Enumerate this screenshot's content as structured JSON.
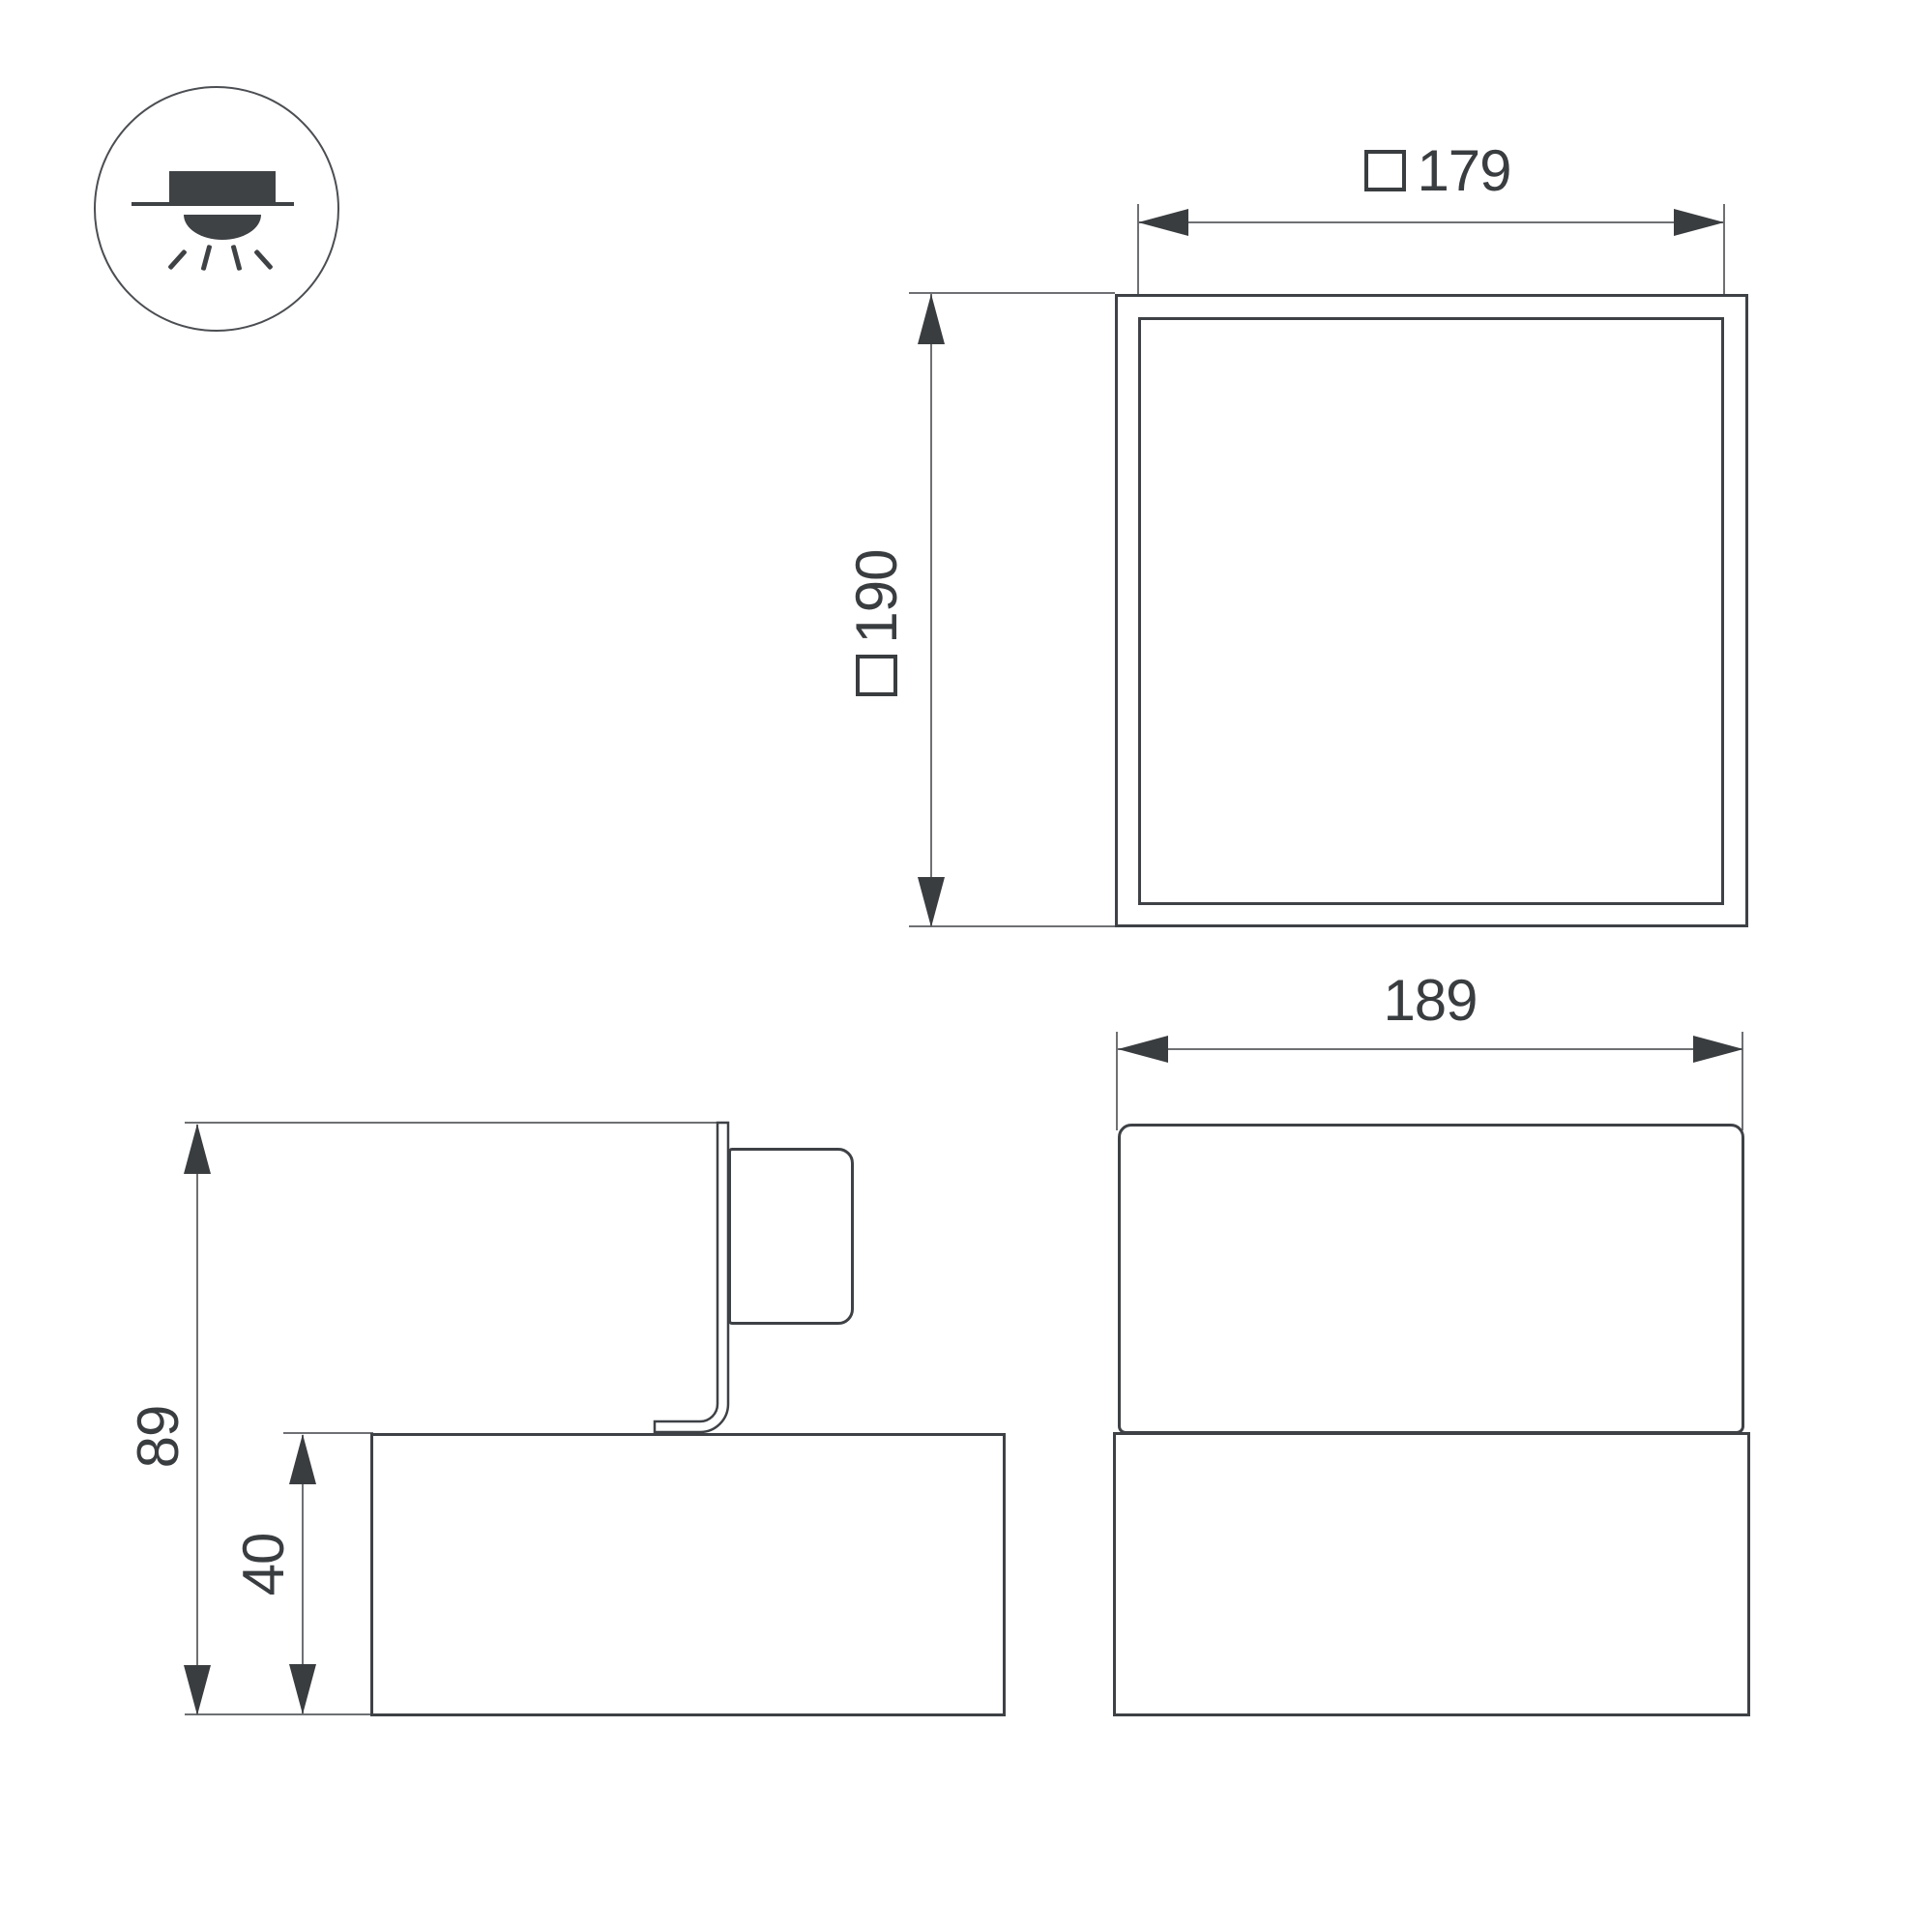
{
  "colors": {
    "background": "#ffffff",
    "outline": "#3e4145",
    "dimension_lines": "#6e7073",
    "text": "#3a3d40"
  },
  "icon": {
    "name": "surface-mounted-downlight",
    "glyphs": [
      "lamp-body",
      "ceiling-line",
      "light-dome",
      "light-rays"
    ]
  },
  "views": {
    "top": {
      "inner_width_label": {
        "square_prefix": true,
        "value": "179"
      },
      "outer_size_label": {
        "square_prefix": true,
        "value": "190"
      }
    },
    "side": {
      "total_height_label": {
        "square_prefix": false,
        "value": "89"
      },
      "base_height_label": {
        "square_prefix": false,
        "value": "40"
      }
    },
    "front": {
      "width_label": {
        "square_prefix": false,
        "value": "189"
      }
    }
  }
}
